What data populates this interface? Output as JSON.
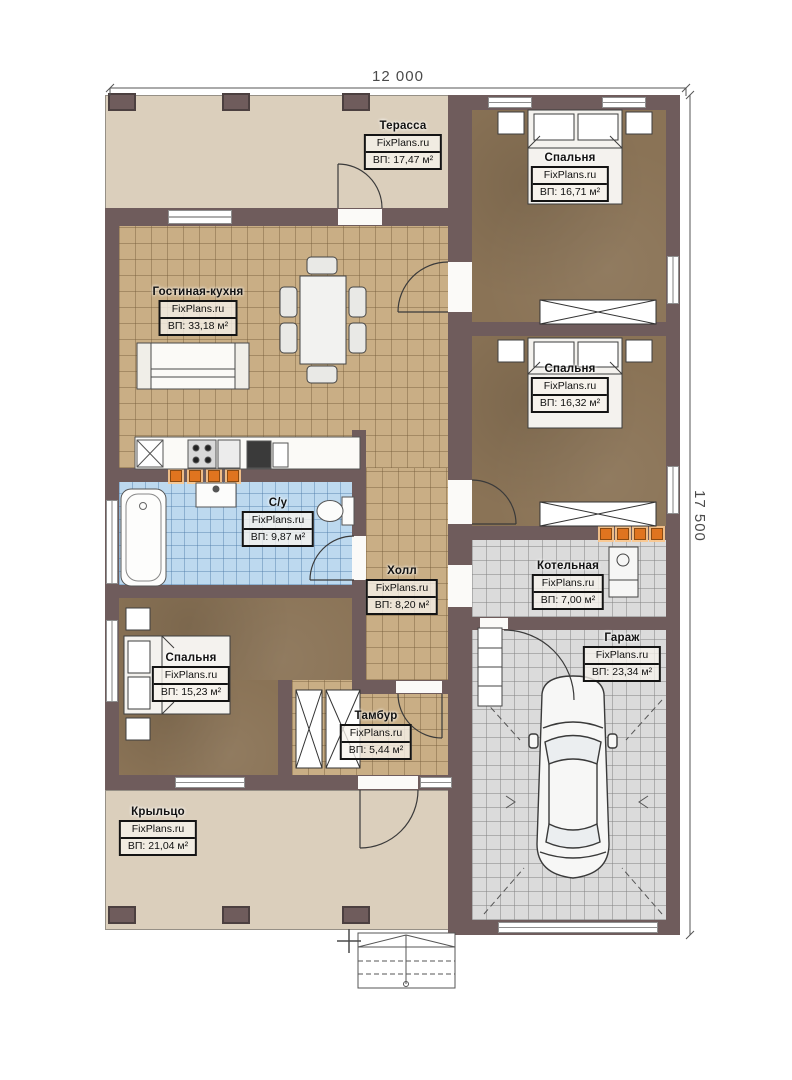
{
  "dimensions": {
    "width": "12 000",
    "height": "17 500"
  },
  "watermark": "FixPlans.ru",
  "rooms": [
    {
      "id": "terrace",
      "name": "Терасса",
      "area": "ВП: 17,47 м²"
    },
    {
      "id": "bedroom1",
      "name": "Спальня",
      "area": "ВП: 16,71 м²"
    },
    {
      "id": "living",
      "name": "Гостиная-кухня",
      "area": "ВП: 33,18 м²"
    },
    {
      "id": "bedroom2",
      "name": "Спальня",
      "area": "ВП: 16,32 м²"
    },
    {
      "id": "bathroom",
      "name": "С/у",
      "area": "ВП: 9,87 м²"
    },
    {
      "id": "hall",
      "name": "Холл",
      "area": "ВП: 8,20 м²"
    },
    {
      "id": "boiler",
      "name": "Котельная",
      "area": "ВП: 7,00 м²"
    },
    {
      "id": "garage",
      "name": "Гараж",
      "area": "ВП: 23,34 м²"
    },
    {
      "id": "bedroom3",
      "name": "Спальня",
      "area": "ВП: 15,23 м²"
    },
    {
      "id": "tambour",
      "name": "Тамбур",
      "area": "ВП: 5,44 м²"
    },
    {
      "id": "porch",
      "name": "Крыльцо",
      "area": "ВП: 21,04 м²"
    }
  ],
  "colors": {
    "wall": "#6f5c5c",
    "deck": "#dbcfbc",
    "tile_tan": "#c9ae85",
    "tile_blue": "#bdd9ef",
    "tile_gray": "#dbdbdb",
    "floor_wood": "#8a7356",
    "vent_orange": "#e0741f"
  }
}
